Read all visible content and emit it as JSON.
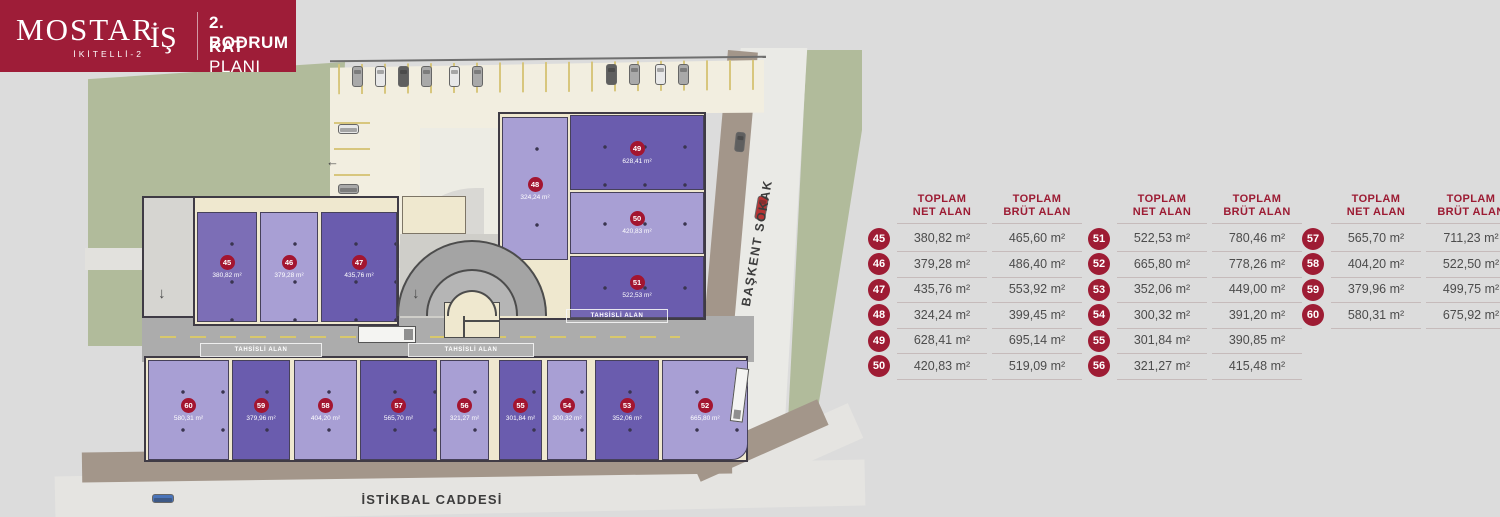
{
  "logo": {
    "brand": "MOSTAR",
    "sub_brand": "İKİTELLİ-2",
    "brand_suffix": "İŞ",
    "title_line1": "2. BODRUM",
    "title_line2_strong": "KAT",
    "title_line2_rest": "PLANI"
  },
  "icons": {
    "arrow_down": "↓",
    "arrow_left": "←"
  },
  "colors": {
    "brand_red": "#9e1d38",
    "badge_red": "#a31530",
    "dark_purple": "#6a5cae",
    "medium_purple": "#7c6eb6",
    "light_purple": "#a89fd4",
    "green": "#b1bb9b",
    "sidewalk_brown": "#a3968a",
    "parking_cream": "#f2eee0",
    "road_gray": "#acacac"
  },
  "plan": {
    "street_right": "BAŞKENT SOKAK",
    "street_bottom": "İSTİKBAL CADDESİ",
    "allocated_zone_label": "TAHSİSLİ ALAN",
    "units": [
      {
        "no": "45",
        "area": "380,82 m²"
      },
      {
        "no": "46",
        "area": "379,28 m²"
      },
      {
        "no": "47",
        "area": "435,76 m²"
      },
      {
        "no": "48",
        "area": "324,24 m²"
      },
      {
        "no": "49",
        "area": "628,41 m²"
      },
      {
        "no": "50",
        "area": "420,83 m²"
      },
      {
        "no": "51",
        "area": "522,53 m²"
      },
      {
        "no": "52",
        "area": "665,80 m²"
      },
      {
        "no": "53",
        "area": "352,06 m²"
      },
      {
        "no": "54",
        "area": "300,32 m²"
      },
      {
        "no": "55",
        "area": "301,84 m²"
      },
      {
        "no": "56",
        "area": "321,27 m²"
      },
      {
        "no": "57",
        "area": "565,70 m²"
      },
      {
        "no": "58",
        "area": "404,20 m²"
      },
      {
        "no": "59",
        "area": "379,96 m²"
      },
      {
        "no": "60",
        "area": "580,31 m²"
      }
    ]
  },
  "tables": [
    {
      "col_net": {
        "line1": "TOPLAM",
        "line2": "NET ALAN"
      },
      "col_brut": {
        "line1": "TOPLAM",
        "line2": "BRÜT ALAN"
      },
      "rows": [
        {
          "no": "45",
          "net": "380,82 m²",
          "brut": "465,60 m²"
        },
        {
          "no": "46",
          "net": "379,28 m²",
          "brut": "486,40 m²"
        },
        {
          "no": "47",
          "net": "435,76 m²",
          "brut": "553,92 m²"
        },
        {
          "no": "48",
          "net": "324,24 m²",
          "brut": "399,45 m²"
        },
        {
          "no": "49",
          "net": "628,41 m²",
          "brut": "695,14 m²"
        },
        {
          "no": "50",
          "net": "420,83 m²",
          "brut": "519,09 m²"
        }
      ]
    },
    {
      "col_net": {
        "line1": "TOPLAM",
        "line2": "NET ALAN"
      },
      "col_brut": {
        "line1": "TOPLAM",
        "line2": "BRÜT ALAN"
      },
      "rows": [
        {
          "no": "51",
          "net": "522,53 m²",
          "brut": "780,46 m²"
        },
        {
          "no": "52",
          "net": "665,80 m²",
          "brut": "778,26 m²"
        },
        {
          "no": "53",
          "net": "352,06 m²",
          "brut": "449,00 m²"
        },
        {
          "no": "54",
          "net": "300,32 m²",
          "brut": "391,20 m²"
        },
        {
          "no": "55",
          "net": "301,84 m²",
          "brut": "390,85 m²"
        },
        {
          "no": "56",
          "net": "321,27 m²",
          "brut": "415,48 m²"
        }
      ]
    },
    {
      "col_net": {
        "line1": "TOPLAM",
        "line2": "NET ALAN"
      },
      "col_brut": {
        "line1": "TOPLAM",
        "line2": "BRÜT ALAN"
      },
      "rows": [
        {
          "no": "57",
          "net": "565,70 m²",
          "brut": "711,23 m²"
        },
        {
          "no": "58",
          "net": "404,20 m²",
          "brut": "522,50 m²"
        },
        {
          "no": "59",
          "net": "379,96 m²",
          "brut": "499,75 m²"
        },
        {
          "no": "60",
          "net": "580,31 m²",
          "brut": "675,92 m²"
        }
      ]
    }
  ]
}
